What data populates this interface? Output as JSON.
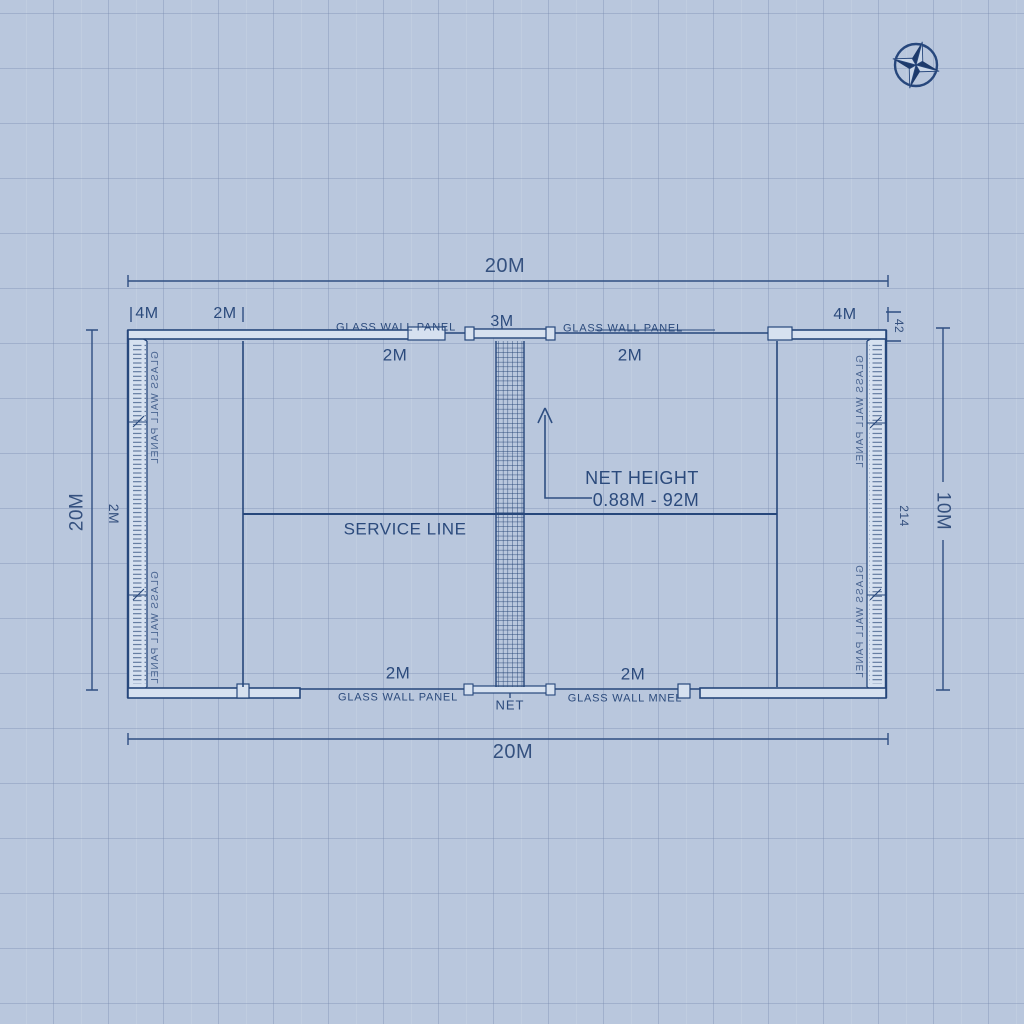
{
  "colors": {
    "background": "#b9c7dd",
    "grid_line": "#8ea2c0",
    "ink": "#26477b",
    "text": "#2b4a7c",
    "wall_fill": "#d6e1f0"
  },
  "icons": {
    "compass": "compass-rose-icon"
  },
  "dimensions": {
    "top_width": "20M",
    "bottom_width": "20M",
    "left_height": "20M",
    "left_offset": "2M",
    "right_height": "10M",
    "right_offset": "214",
    "right_top": "42",
    "back_left": "4M",
    "side_left": "2M",
    "back_right": "4M",
    "net_span": "3M"
  },
  "zones": {
    "top_left": "2M",
    "top_right": "2M",
    "bottom_left": "2M",
    "bottom_right": "2M"
  },
  "walls": {
    "top_left": "GLASS WALL PANEL",
    "top_right": "GLASS WALL PANEL",
    "bottom_left": "GLASS WALL PANEL",
    "bottom_right": "GLASS WALL MNEL",
    "left_upper": "GLASS WALL PANEL",
    "left_lower": "GLASS WALL PANEL",
    "right_upper": "GLASS WALL PANEL",
    "right_lower": "GLASS WALL PANEL"
  },
  "net": {
    "label": "NET",
    "height_title": "NET HEIGHT",
    "height_value": "0.88M - 92M"
  },
  "service_line": {
    "label": "SERVICE LINE"
  }
}
